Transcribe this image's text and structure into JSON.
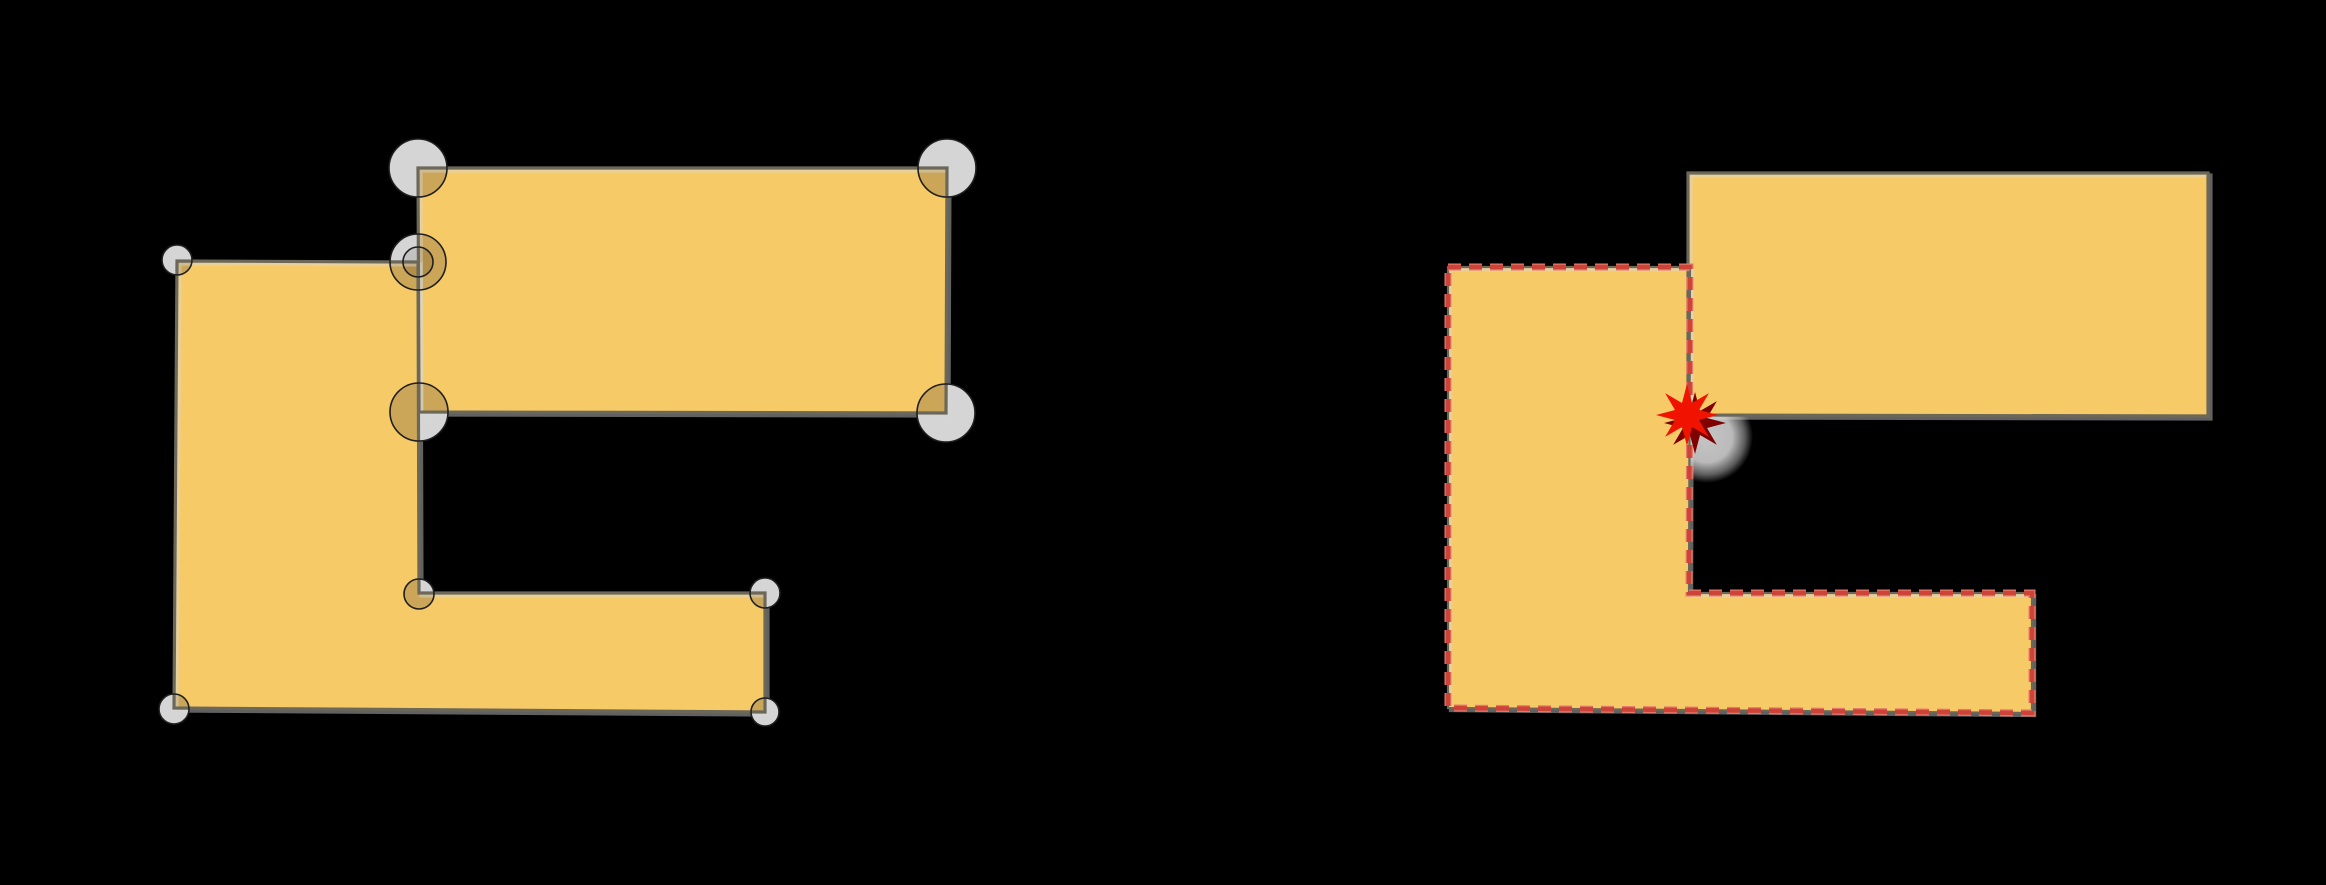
{
  "canvas": {
    "width": 2326,
    "height": 885,
    "background": "#000000"
  },
  "colors": {
    "polygon_fill": "#F7CA68",
    "polygon_outline": "#6B6859",
    "outline_highlight": "rgba(215,215,215,0.45)",
    "tolerance_circle_gray": "#D5D5D5",
    "tolerance_circle_gray_inner": "#C2C2C2",
    "tolerance_circle_tan": "#CBA558",
    "tolerance_circle_tan_inner": "#B28F49",
    "tolerance_circle_stroke": "#1F1F1F",
    "dash_red": "#CE4337",
    "dash_red_halo": "#E2796C",
    "star_red": "#F01400",
    "star_shadow": "#7E0000",
    "shadow_blob_gray": "#CFCFCF"
  },
  "left_figure": {
    "name": "input-geometries-with-tolerance-circles",
    "l_polygon": [
      [
        177,
        261
      ],
      [
        418,
        262
      ],
      [
        419,
        593
      ],
      [
        765,
        593
      ],
      [
        765,
        712
      ],
      [
        174,
        708
      ]
    ],
    "rectangle": [
      [
        418,
        168
      ],
      [
        947,
        168
      ],
      [
        946,
        413
      ],
      [
        419,
        412
      ]
    ],
    "tolerance_circles": [
      {
        "cx": 418,
        "cy": 168,
        "r": 29,
        "kind": "large"
      },
      {
        "cx": 947,
        "cy": 168,
        "r": 29,
        "kind": "large"
      },
      {
        "cx": 946,
        "cy": 413,
        "r": 29,
        "kind": "large"
      },
      {
        "cx": 419,
        "cy": 412,
        "r": 29,
        "kind": "large"
      },
      {
        "cx": 418,
        "cy": 262,
        "r": 28,
        "kind": "large"
      },
      {
        "cx": 177,
        "cy": 260,
        "r": 15,
        "kind": "small"
      },
      {
        "cx": 419,
        "cy": 594,
        "r": 15,
        "kind": "small"
      },
      {
        "cx": 765,
        "cy": 593,
        "r": 15,
        "kind": "small"
      },
      {
        "cx": 174,
        "cy": 709,
        "r": 15,
        "kind": "small"
      },
      {
        "cx": 765,
        "cy": 712,
        "r": 14,
        "kind": "small"
      },
      {
        "cx": 418,
        "cy": 262,
        "r": 15,
        "kind": "inner"
      }
    ],
    "outline_width": 3.2,
    "circle_stroke_width": 1.6
  },
  "right_figure": {
    "name": "snapped-result-with-dashed-boundary",
    "l_polygon": [
      [
        1448,
        267
      ],
      [
        1690,
        267
      ],
      [
        1689,
        593
      ],
      [
        2032,
        593
      ],
      [
        2032,
        713
      ],
      [
        1448,
        708
      ]
    ],
    "rectangle": [
      [
        1688,
        173
      ],
      [
        2208,
        173
      ],
      [
        2208,
        416
      ],
      [
        1688,
        415
      ]
    ],
    "dash_pattern": [
      13,
      8
    ],
    "dash_width_main": 4.5,
    "dash_width_halo": 7,
    "underline_width": 2.2,
    "star": {
      "cx": 1687,
      "cy": 415,
      "outer_r": 31,
      "inner_r": 13,
      "points": 8,
      "shadow_dx": 8,
      "shadow_dy": 8
    },
    "shadow_blob": {
      "cx": 1707,
      "cy": 437,
      "r": 46
    }
  }
}
